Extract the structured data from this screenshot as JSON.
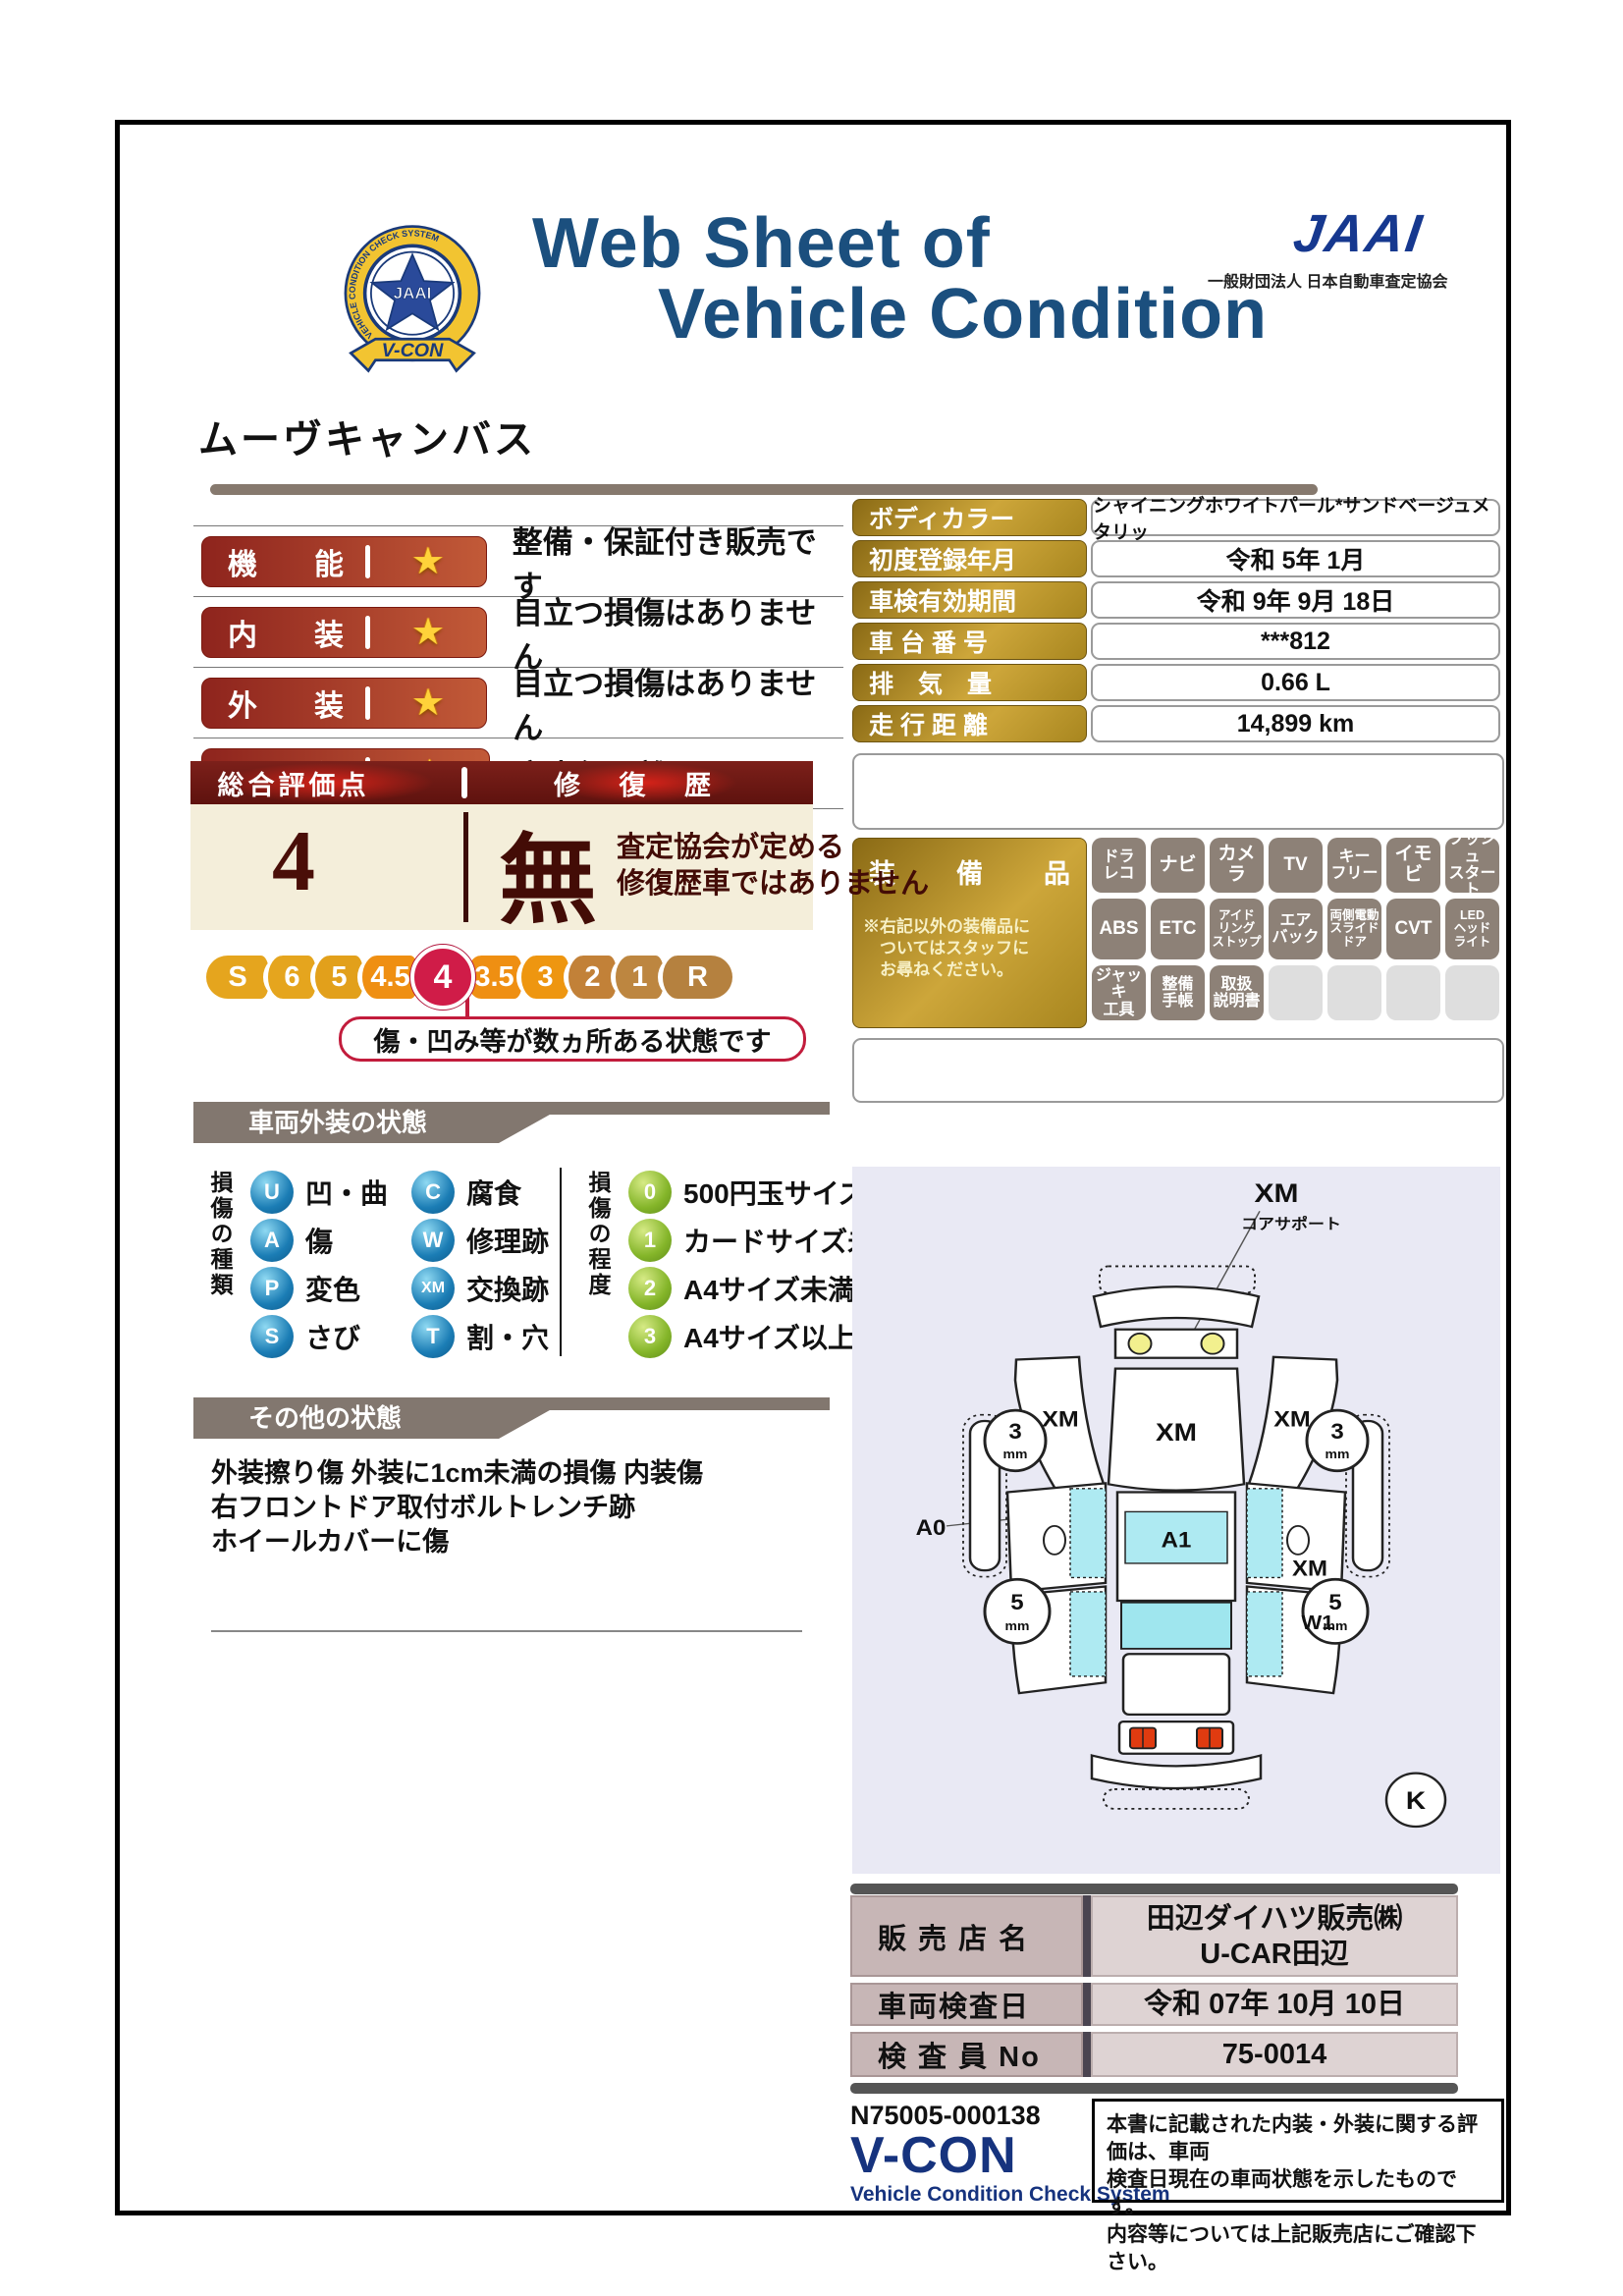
{
  "header": {
    "title_line1": "Web Sheet of",
    "title_line2": "Vehicle Condition",
    "jaai_logo": "JAAI",
    "jaai_subtitle": "一般財団法人 日本自動車査定協会",
    "badge": {
      "vcon": "V-CON",
      "ring_text": "VEHICLE CONDITION CHECK SYSTEM",
      "star_text": "JAAI"
    }
  },
  "vehicle_name": "ムーヴキャンバス",
  "ratings": [
    {
      "label": "機能",
      "stars": 1,
      "description": "整備・保証付き販売です"
    },
    {
      "label": "内装",
      "stars": 1,
      "description": "目立つ損傷はありません"
    },
    {
      "label": "外装",
      "stars": 1,
      "description": "目立つ損傷はありません"
    },
    {
      "label": "走行",
      "stars": 1,
      "description": "実走行距離です"
    }
  ],
  "info_table": [
    {
      "label": "ボディカラー",
      "value": "シャイニングホワイトパール*サンドベージュメタリッ",
      "small": true
    },
    {
      "label": "初度登録年月",
      "value": "令和 5年 1月"
    },
    {
      "label": "車検有効期間",
      "value": "令和 9年 9月 18日"
    },
    {
      "label": "車 台 番 号",
      "value": "***812"
    },
    {
      "label": "排　気　量",
      "value": "0.66 L"
    },
    {
      "label": "走 行 距 離",
      "value": "14,899 km"
    }
  ],
  "overall": {
    "header_left": "総合評価点",
    "header_right": "修 復 歴",
    "score": "4",
    "repair": "無",
    "repair_note_line1": "査定協会が定める",
    "repair_note_line2": "修復歴車ではありません",
    "scale": [
      "S",
      "6",
      "5",
      "4.5",
      "4",
      "3.5",
      "3",
      "2",
      "1",
      "R"
    ],
    "selected": "4",
    "scale_colors": [
      "#e5a51e",
      "#e5a51e",
      "#e2a01b",
      "#ef8f12",
      "#d01c48",
      "#ef8f12",
      "#ee9610",
      "#c28138",
      "#bd8640",
      "#b5813f"
    ],
    "scale_widths": [
      64,
      54,
      54,
      62,
      66,
      62,
      54,
      54,
      54,
      76
    ],
    "callout": "傷・凹み等が数ヵ所ある状態です"
  },
  "equipment": {
    "label": "装備品",
    "note_lines": [
      "※右記以外の装備品に",
      "　ついてはスタッフに",
      "　お尋ねください。"
    ],
    "items": [
      {
        "lines": [
          "ドラ",
          "レコ"
        ]
      },
      {
        "lines": [
          "ナビ"
        ]
      },
      {
        "lines": [
          "カメラ"
        ]
      },
      {
        "lines": [
          "TV"
        ]
      },
      {
        "lines": [
          "キー",
          "フリー"
        ]
      },
      {
        "lines": [
          "イモビ"
        ]
      },
      {
        "lines": [
          "プッシュ",
          "スタート"
        ]
      },
      {
        "lines": [
          "ABS"
        ]
      },
      {
        "lines": [
          "ETC"
        ]
      },
      {
        "lines": [
          "アイド",
          "リング",
          "ストップ"
        ]
      },
      {
        "lines": [
          "エア",
          "バック"
        ]
      },
      {
        "lines": [
          "両側電動",
          "スライド",
          "ドア"
        ]
      },
      {
        "lines": [
          "CVT"
        ]
      },
      {
        "lines": [
          "LED",
          "ヘッド",
          "ライト"
        ]
      },
      {
        "lines": [
          "ジャッキ",
          "工具"
        ]
      },
      {
        "lines": [
          "整備",
          "手帳"
        ]
      },
      {
        "lines": [
          "取扱",
          "説明書"
        ]
      },
      {
        "lines": [],
        "empty": true
      },
      {
        "lines": [],
        "empty": true
      },
      {
        "lines": [],
        "empty": true
      },
      {
        "lines": [],
        "empty": true
      }
    ]
  },
  "exterior_section": {
    "title": "車両外装の状態",
    "type_label": "損傷の種類",
    "types": [
      {
        "code": "U",
        "label": "凹・曲"
      },
      {
        "code": "A",
        "label": "傷"
      },
      {
        "code": "P",
        "label": "変色"
      },
      {
        "code": "S",
        "label": "さび"
      },
      {
        "code": "C",
        "label": "腐食"
      },
      {
        "code": "W",
        "label": "修理跡"
      },
      {
        "code": "XM",
        "label": "交換跡"
      },
      {
        "code": "T",
        "label": "割・穴"
      }
    ],
    "degree_label": "損傷の程度",
    "degrees": [
      {
        "code": "0",
        "label": "500円玉サイズ未満"
      },
      {
        "code": "1",
        "label": "カードサイズ未満"
      },
      {
        "code": "2",
        "label": "A4サイズ未満"
      },
      {
        "code": "3",
        "label": "A4サイズ以上"
      }
    ]
  },
  "other_section": {
    "title": "その他の状態",
    "lines": [
      "外装擦り傷 外装に1cm未満の損傷 内装傷",
      "右フロントドア取付ボルトレンチ跡",
      "ホイールカバーに傷"
    ]
  },
  "diagram": {
    "core_support_code": "XM",
    "core_support_label": "コアサポート",
    "hood": "XM",
    "left_fender": "XM",
    "right_fender": "XM",
    "roof_front": "A1",
    "right_side": "XM",
    "right_rear": "W1",
    "left_rear": "A0",
    "front_wheel_size": "3",
    "rear_wheel_size": "5",
    "wheel_unit": "mm",
    "corner_mark": "K"
  },
  "dealer_table": [
    {
      "label": "販 売 店 名",
      "value_lines": [
        "田辺ダイハツ販売㈱",
        "U-CAR田辺"
      ]
    },
    {
      "label": "車両検査日",
      "value_lines": [
        "令和 07年 10月 10日"
      ]
    },
    {
      "label": "検 査 員 No",
      "value_lines": [
        "75-0014"
      ]
    }
  ],
  "footer": {
    "doc_number": "N75005-000138",
    "vcon": "V-CON",
    "vcon_sub": "Vehicle Condition Check System",
    "note_lines": [
      "本書に記載された内装・外装に関する評価は、車両",
      "検査日現在の車両状態を示したものです。",
      "内容等については上記販売店にご確認下さい。"
    ]
  },
  "colors": {
    "title_blue": "#1b4f7e",
    "jaai_blue": "#16388f",
    "badge_red_dark": "#8e241d",
    "badge_red_light": "#c25a38",
    "gold_dark": "#8a6a15",
    "gold_light": "#cda63a",
    "maroon": "#5e120e",
    "cream": "#f4eeda",
    "crimson": "#d01c48",
    "legend_blue": "#1b7db5",
    "legend_green": "#84b529",
    "section_gray": "#82776f",
    "panel_lavender": "#e9e9f4",
    "cyan_glass": "#aeeaf2",
    "table_pink": "#c7b6b6",
    "table_pink_light": "#ded3d3",
    "star_gold": "#ffd23a"
  }
}
